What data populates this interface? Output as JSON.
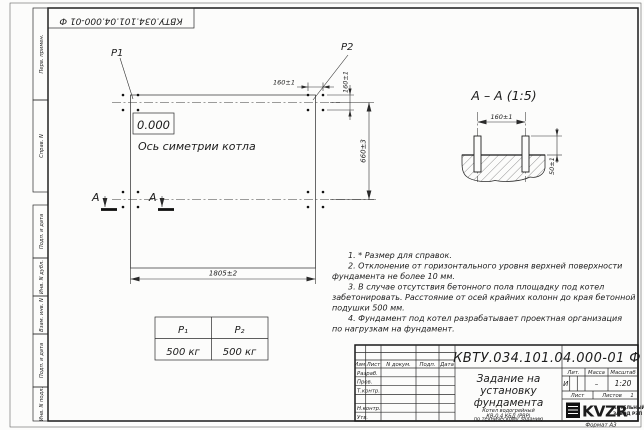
{
  "corner_stamp": {
    "doc_number": "КВТУ.034.101.04.000-01  Ф"
  },
  "margin_labels": [
    "Перв. примен.",
    "Справ. N",
    "Подп. и дата",
    "Инв. N дубл.",
    "Взам. инв. N",
    "Подп. и дата",
    "Инв. N подл."
  ],
  "plan_view": {
    "p1_label": "P1",
    "p2_label": "P2",
    "elevation": "0.000",
    "axis_label": "Ось симетрии котла",
    "dim_width": "1805±2",
    "dim_height": "660±3",
    "dim_bolt_x": "160±1",
    "dim_bolt_y": "160±1",
    "section_letter_left": "А",
    "section_letter_right": "А"
  },
  "section_view": {
    "title": "А – А (1:5)",
    "dim_spacing": "160±1",
    "dim_protrusion": "50±1"
  },
  "load_table": {
    "headers": [
      "Р₁",
      "Р₂"
    ],
    "values": [
      "500 кг",
      "500 кг"
    ]
  },
  "notes": [
    "1. * Размер для справок.",
    "2. Отклонение от горизонтального уровня верхней поверхности",
    "фундамента не более 10 мм.",
    "3. В случае отсутствия бетонного пола площадку под котел",
    "забетонировать. Расстояние от осей крайних колонн до края бетонной",
    "подушки 500 мм.",
    "4. Фундамент под котел разрабатывает проектная организация",
    "по нагрузкам на фундамент."
  ],
  "title_block": {
    "doc_number": "КВТУ.034.101.04.000-01  Ф",
    "title_lines": [
      "Задание на",
      "установку",
      "фундамента"
    ],
    "subtitle_lines": [
      "Котел водогрейный",
      "КВ-0,4  КБД  (РВР)",
      "по техническому заданию"
    ],
    "columns": [
      "Изм.",
      "Лист",
      "N докум.",
      "Подп.",
      "Дата"
    ],
    "rows": [
      "Разраб.",
      "Пров.",
      "Т.контр.",
      "Н.контр.",
      "Утв."
    ],
    "lit_header": "Лит.",
    "lit_value": "И",
    "mass_header": "Масса",
    "mass_value": "–",
    "scale_header": "Масштаб",
    "scale_value": "1:20",
    "sheet_label": "Лист",
    "sheets_label": "Листов",
    "sheets_value": "1",
    "logo_text": "KVZR",
    "logo_caption_lines": [
      "КОТЕЛЬНЫЙ",
      "ЗАВОД РЭП"
    ],
    "format_label": "Формат А3"
  }
}
